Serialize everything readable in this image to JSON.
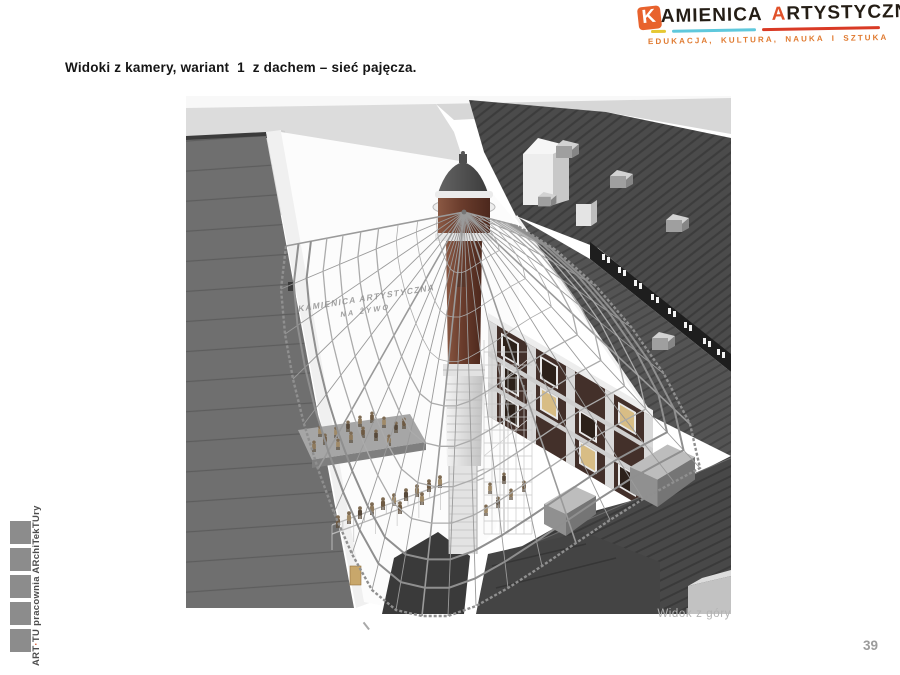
{
  "logo": {
    "word1_initial": "K",
    "word1_rest": "AMIENICA",
    "word2_initial": "A",
    "word2_rest": "RTYSTYCZNA",
    "subtitle": "EDUKACJA, KULTURA, NAUKA I SZTUKA",
    "colors": {
      "accent_orange": "#e8622d",
      "underline_yellow": "#e6c832",
      "underline_cyan": "#5fc8dc",
      "underline_red": "#d93a25"
    }
  },
  "slide": {
    "title": "Widoki z kamery, wariant  1  z dachem – sieć pajęcza.",
    "page_number": "39"
  },
  "figure": {
    "caption": "Widok z góry",
    "web_label_line1": "KAMIENICA ARTYSTYCZNA",
    "web_label_line2": "NA ŻYWO"
  },
  "footer": {
    "studio_part1": "ART",
    "studio_separator": "·",
    "studio_part2": "TU pracownia ARchiTekTUry"
  }
}
